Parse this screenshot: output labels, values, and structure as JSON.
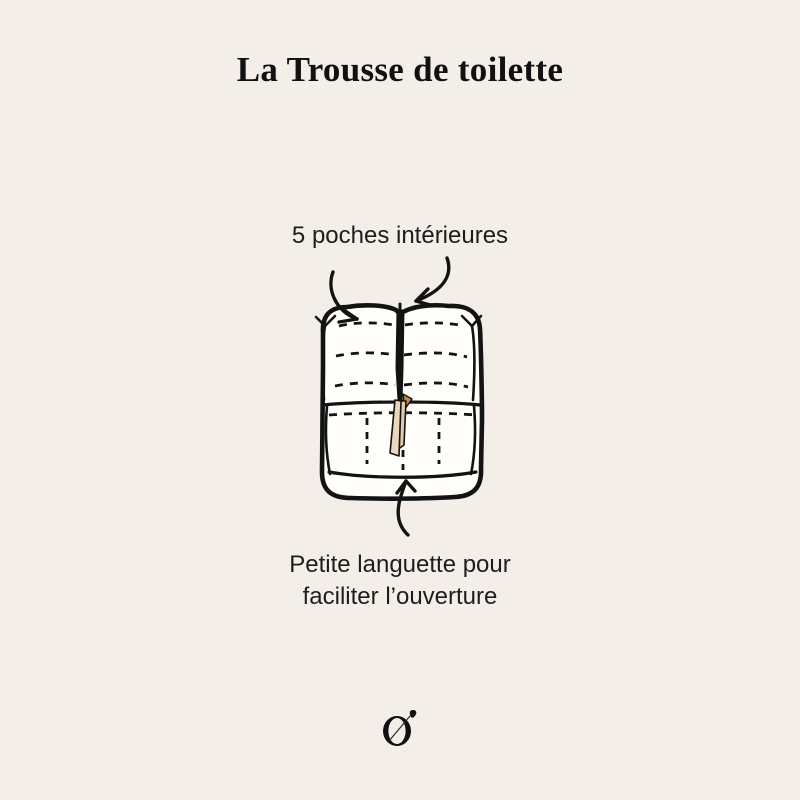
{
  "page": {
    "background_color": "#f3efe8",
    "ink_color": "#131313"
  },
  "title": "La Trousse de toilette",
  "annotations": {
    "pockets": "5 poches intérieures",
    "tab_line1": "Petite languette pour",
    "tab_line2": "faciliter l’ouverture"
  },
  "illustration": {
    "name": "open-toiletry-bag-top-view",
    "bag_fill_color": "#fffefb",
    "outline_color": "#131313",
    "tab_color": "#ead8ba",
    "tab_shadow_color": "#e0cba6",
    "tab_accent_color": "#c98a3c"
  },
  "logo": {
    "glyph": "O",
    "mark": "leaf"
  }
}
